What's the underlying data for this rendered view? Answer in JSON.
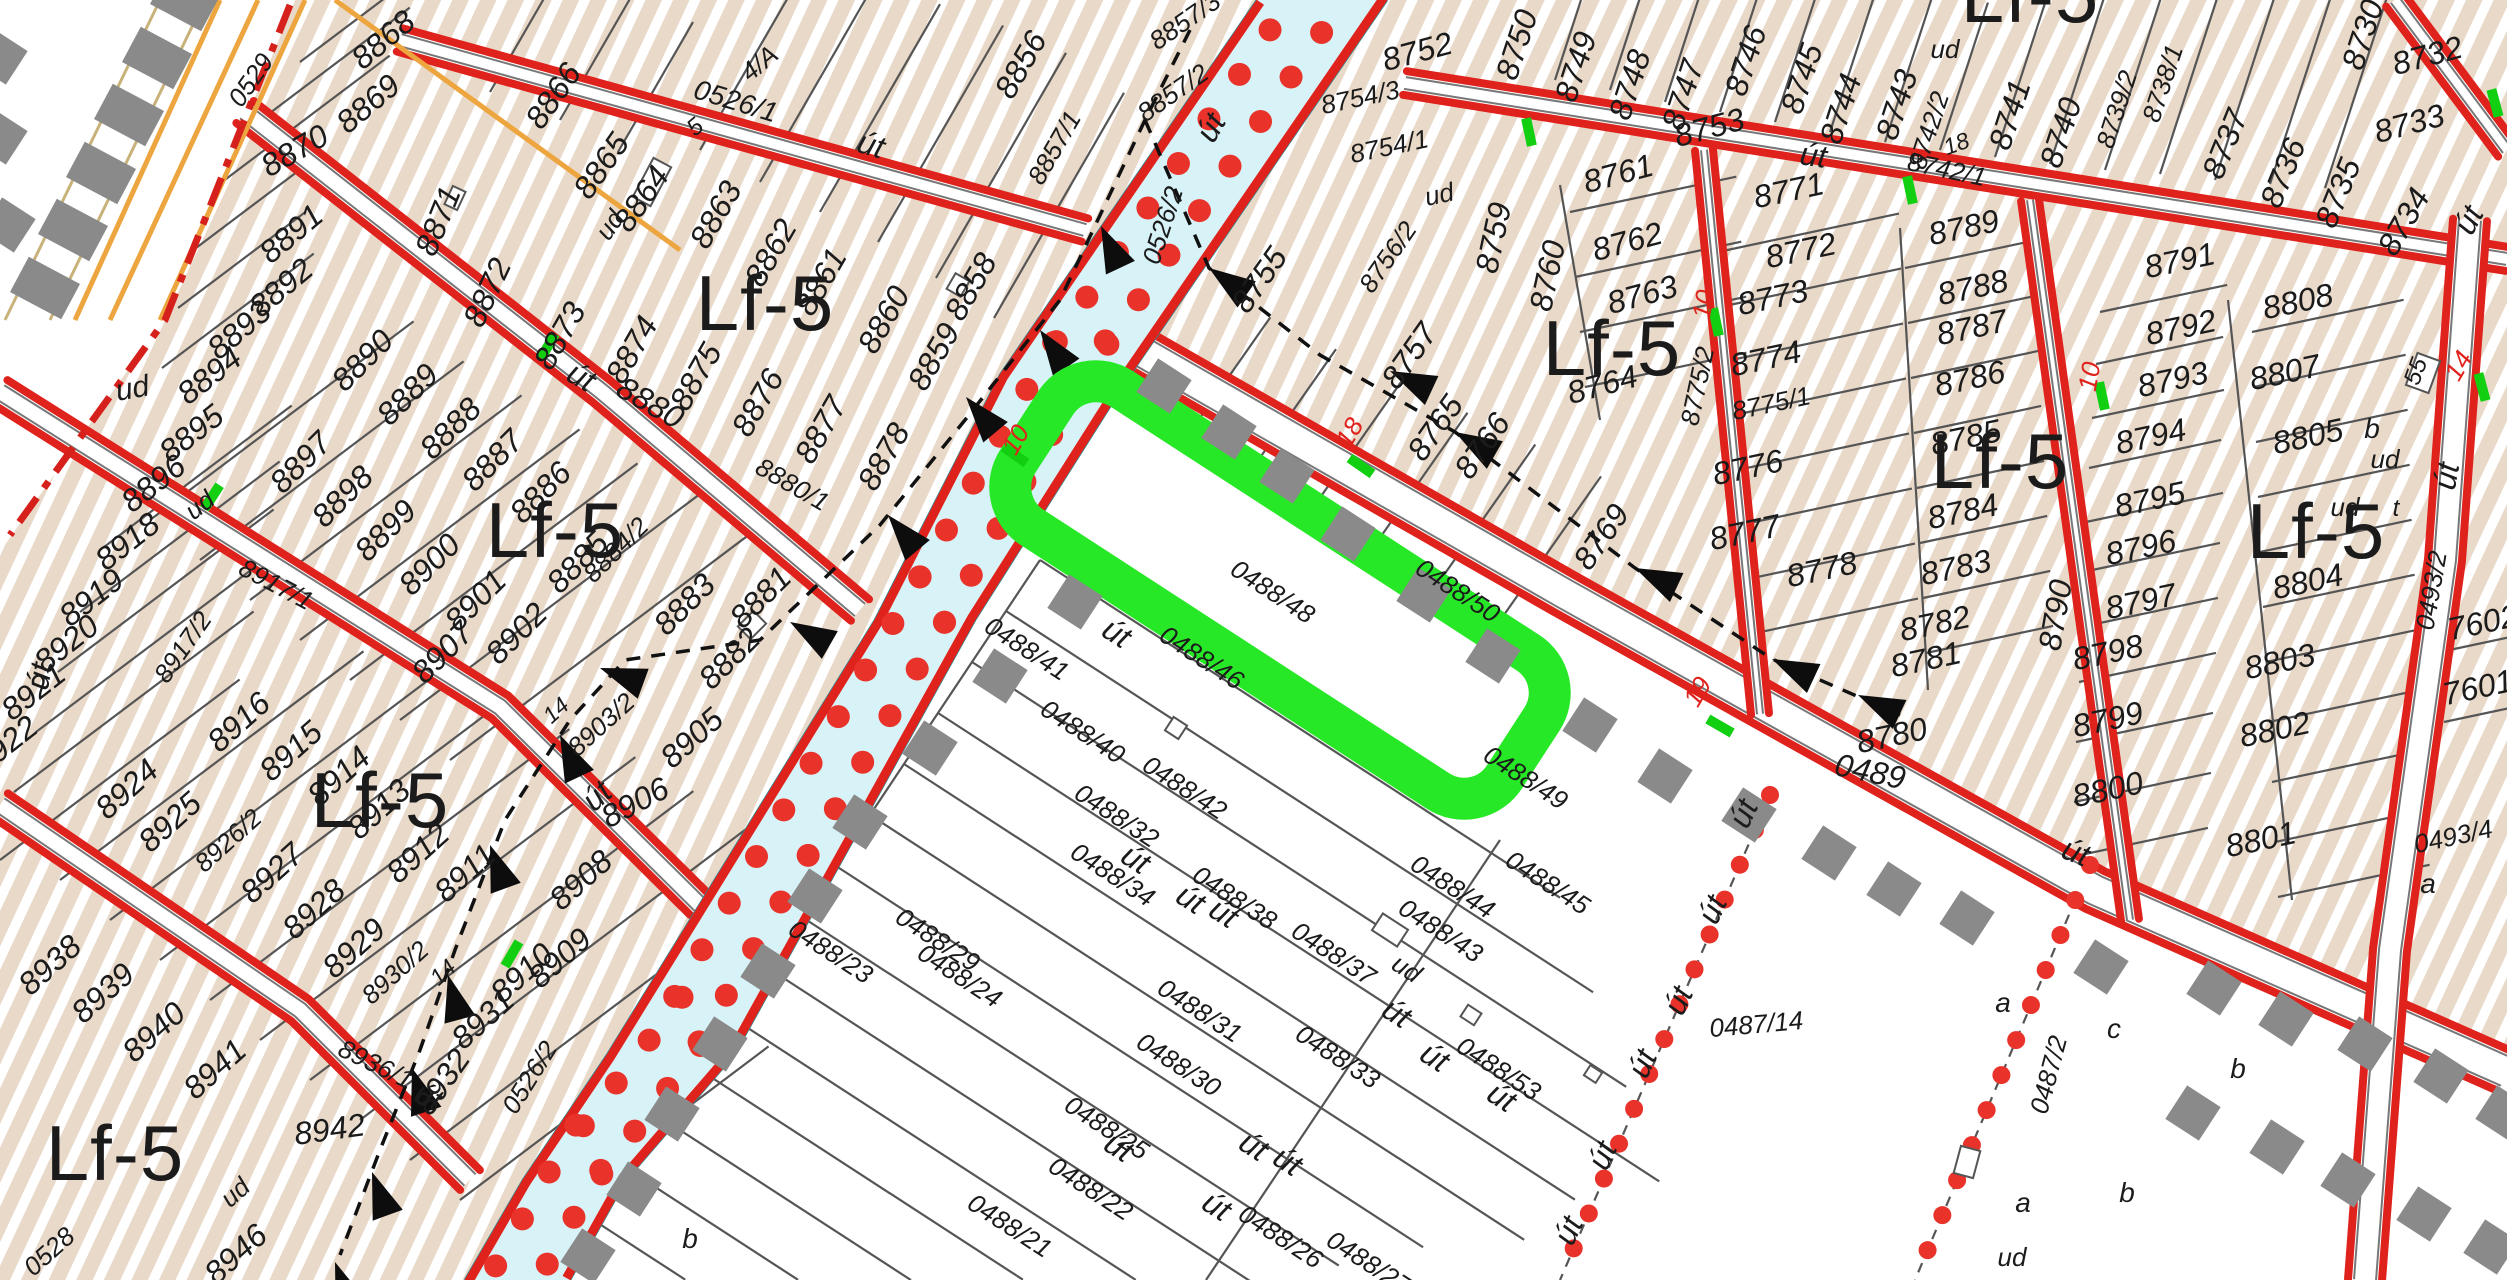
{
  "map": {
    "type": "cadastral-zoning-map",
    "highlighted_parcel": "0488/48",
    "zone_code": "Lf-5",
    "canal_parcel": "0526/2",
    "road_parcels": [
      "0526/1",
      "0489",
      "8880",
      "8917/1",
      "8936/1",
      "0493/2"
    ]
  },
  "colors": {
    "road_red": "#e0221c",
    "boundary_red": "#d6201b",
    "dot_red": "#e8322a",
    "hatch_bg": "#e9d9c9",
    "hatch_stripe": "#ffffff",
    "canal_fill": "#d8f3f8",
    "canal_edge": "#2b8c96",
    "highlight_green": "#27e827",
    "tick_green": "#12cf12",
    "railway_orange": "#eda63f",
    "square_gray": "#8a8a8a",
    "parcel_line": "#555555",
    "label_black": "#1b1b1b"
  },
  "zone_labels": [
    {
      "t": "Lf-5",
      "x": 765,
      "y": 330
    },
    {
      "t": "Lf-5",
      "x": 555,
      "y": 557
    },
    {
      "t": "Lf-5",
      "x": 380,
      "y": 827
    },
    {
      "t": "Lf-5",
      "x": 115,
      "y": 1180
    },
    {
      "t": "Lf-5",
      "x": 1612,
      "y": 375
    },
    {
      "t": "Lf-5",
      "x": 2000,
      "y": 488
    },
    {
      "t": "Lf-5",
      "x": 2316,
      "y": 558
    },
    {
      "t": "Lf-5",
      "x": 2030,
      "y": 22
    }
  ],
  "red_labels": [
    [
      "10",
      1023,
      444,
      -60
    ],
    [
      "18",
      1357,
      437,
      -60
    ],
    [
      "19",
      1705,
      696,
      -60
    ],
    [
      "10",
      1712,
      306,
      -80
    ],
    [
      "10",
      2098,
      378,
      -80
    ],
    [
      "14",
      2466,
      370,
      -60
    ]
  ],
  "labels": [
    [
      "0529",
      258,
      85,
      -55,
      26
    ],
    [
      "8868",
      390,
      48,
      -40
    ],
    [
      "8869",
      375,
      112,
      -40
    ],
    [
      "8870",
      300,
      160,
      -30
    ],
    [
      "8891",
      298,
      242,
      -40
    ],
    [
      "8892",
      288,
      296,
      -40
    ],
    [
      "8893",
      246,
      338,
      -40
    ],
    [
      "8894",
      216,
      384,
      -38
    ],
    [
      "8895",
      198,
      442,
      -38
    ],
    [
      "8896",
      160,
      492,
      -38
    ],
    [
      "ud",
      205,
      512,
      -38,
      26
    ],
    [
      "ud",
      134,
      398,
      -10,
      30
    ],
    [
      "8890",
      370,
      368,
      -45
    ],
    [
      "8889",
      415,
      402,
      -45
    ],
    [
      "8888",
      458,
      436,
      -45
    ],
    [
      "8897",
      308,
      470,
      -45
    ],
    [
      "8898",
      350,
      504,
      -45
    ],
    [
      "8899",
      393,
      538,
      -45
    ],
    [
      "8900",
      437,
      572,
      -45
    ],
    [
      "8901",
      483,
      608,
      -45
    ],
    [
      "8902",
      524,
      641,
      -45
    ],
    [
      "8918",
      134,
      550,
      -38
    ],
    [
      "8919",
      98,
      606,
      -38
    ],
    [
      "8920",
      73,
      652,
      -38
    ],
    [
      "8921",
      40,
      700,
      -38
    ],
    [
      "8922",
      12,
      753,
      -38
    ],
    [
      "8917/2",
      190,
      652,
      -55,
      26
    ],
    [
      "8917/1",
      272,
      592,
      28,
      26
    ],
    [
      "út",
      50,
      678,
      -80
    ],
    [
      "8907",
      450,
      660,
      -45
    ],
    [
      "8871",
      448,
      225,
      -68
    ],
    [
      "8872",
      497,
      297,
      -65
    ],
    [
      "8873",
      569,
      341,
      -60
    ],
    [
      "8874",
      641,
      355,
      -60
    ],
    [
      "8875",
      705,
      382,
      -60
    ],
    [
      "8876",
      767,
      408,
      -60
    ],
    [
      "8877",
      830,
      435,
      -60
    ],
    [
      "8878",
      893,
      462,
      -60
    ],
    [
      "8887",
      500,
      468,
      -45
    ],
    [
      "8886",
      548,
      500,
      -45
    ],
    [
      "8885",
      585,
      570,
      -45
    ],
    [
      "8884/2",
      622,
      556,
      -45,
      26
    ],
    [
      "8883",
      692,
      612,
      -45
    ],
    [
      "8881",
      768,
      605,
      -45
    ],
    [
      "8882",
      737,
      666,
      -45
    ],
    [
      "út",
      576,
      386,
      30
    ],
    [
      "8880",
      645,
      412,
      30
    ],
    [
      "8880/1",
      788,
      492,
      30,
      26
    ],
    [
      "8858",
      980,
      292,
      -60
    ],
    [
      "8859",
      943,
      362,
      -60
    ],
    [
      "8860",
      893,
      325,
      -60
    ],
    [
      "8861",
      830,
      287,
      -60
    ],
    [
      "8862",
      780,
      258,
      -60
    ],
    [
      "8863",
      725,
      220,
      -60
    ],
    [
      "8864",
      650,
      205,
      -55
    ],
    [
      "ud",
      617,
      230,
      -55,
      26
    ],
    [
      "8865",
      610,
      172,
      -55
    ],
    [
      "8866",
      562,
      102,
      -55
    ],
    [
      "5",
      700,
      133,
      -40,
      24
    ],
    [
      "4/A",
      765,
      70,
      -40,
      26
    ],
    [
      "0526/1",
      733,
      110,
      17,
      28
    ],
    [
      "út",
      868,
      155,
      17
    ],
    [
      "8856",
      1030,
      70,
      -60
    ],
    [
      "8857/3",
      1190,
      28,
      -35,
      26
    ],
    [
      "8857/2",
      1178,
      100,
      -35,
      26
    ],
    [
      "8857/1",
      1062,
      152,
      -60,
      26
    ],
    [
      "út",
      1220,
      133,
      -60
    ],
    [
      "0526/2",
      1171,
      228,
      -72,
      26
    ],
    [
      "0526/2",
      537,
      1082,
      -58,
      26
    ],
    [
      "8936/1",
      372,
      1072,
      26,
      26
    ],
    [
      "út",
      424,
      1106,
      26
    ],
    [
      "8924",
      134,
      797,
      -42
    ],
    [
      "8925",
      177,
      830,
      -42
    ],
    [
      "8926/2",
      234,
      847,
      -42,
      26
    ],
    [
      "8916",
      246,
      730,
      -42
    ],
    [
      "8915",
      298,
      759,
      -42
    ],
    [
      "8914",
      346,
      784,
      -42
    ],
    [
      "8913",
      386,
      817,
      -42
    ],
    [
      "8912",
      425,
      861,
      -42
    ],
    [
      "8911",
      472,
      881,
      -42
    ],
    [
      "8927",
      279,
      881,
      -42
    ],
    [
      "8928",
      321,
      917,
      -42
    ],
    [
      "8929",
      361,
      956,
      -42
    ],
    [
      "8930/2",
      401,
      979,
      -42,
      26
    ],
    [
      "14",
      448,
      978,
      -42,
      23
    ],
    [
      "8938",
      57,
      973,
      -42
    ],
    [
      "8939",
      110,
      1001,
      -42
    ],
    [
      "8940",
      161,
      1040,
      -42
    ],
    [
      "8941",
      222,
      1077,
      -42
    ],
    [
      "8942",
      331,
      1140,
      -8
    ],
    [
      "8946",
      243,
      1262,
      -42
    ],
    [
      "8931",
      490,
      1027,
      -42
    ],
    [
      "8932",
      451,
      1088,
      -55
    ],
    [
      "8910",
      529,
      981,
      -42
    ],
    [
      "8909",
      567,
      966,
      -42
    ],
    [
      "8908",
      588,
      888,
      -42
    ],
    [
      "8906",
      640,
      812,
      -28
    ],
    [
      "út",
      604,
      804,
      -42
    ],
    [
      "8905",
      699,
      746,
      -42
    ],
    [
      "8903/2",
      607,
      731,
      -42,
      26
    ],
    [
      "14",
      561,
      716,
      -42,
      23
    ],
    [
      "0528",
      55,
      1258,
      -42,
      26
    ],
    [
      "ud",
      241,
      1199,
      -42,
      26
    ],
    [
      "b",
      690,
      1248,
      0,
      28
    ],
    [
      "8752",
      1420,
      62,
      -15
    ],
    [
      "8754/3",
      1362,
      106,
      -12,
      26
    ],
    [
      "8754/1",
      1391,
      155,
      -12,
      26
    ],
    [
      "ud",
      1441,
      203,
      -12,
      26
    ],
    [
      "8756/2",
      1395,
      262,
      -55,
      26
    ],
    [
      "8755",
      1268,
      286,
      -55
    ],
    [
      "8757",
      1418,
      362,
      -55
    ],
    [
      "8759",
      1504,
      240,
      -78
    ],
    [
      "8760",
      1558,
      278,
      -78
    ],
    [
      "8761",
      1621,
      184,
      -15
    ],
    [
      "8762",
      1630,
      252,
      -15
    ],
    [
      "8763",
      1645,
      305,
      -15
    ],
    [
      "8764",
      1605,
      395,
      -15
    ],
    [
      "8750",
      1527,
      48,
      -72
    ],
    [
      "8749",
      1586,
      70,
      -72
    ],
    [
      "8748",
      1640,
      88,
      -72
    ],
    [
      "8747",
      1693,
      98,
      -72
    ],
    [
      "8746",
      1756,
      64,
      -72
    ],
    [
      "8745",
      1812,
      82,
      -72
    ],
    [
      "8744",
      1851,
      112,
      -72
    ],
    [
      "8743",
      1907,
      108,
      -72
    ],
    [
      "8742/2",
      1937,
      133,
      -72,
      26
    ],
    [
      "ud",
      1945,
      58,
      0,
      26
    ],
    [
      "18",
      1959,
      151,
      -20,
      23
    ],
    [
      "8742/1",
      1945,
      178,
      12,
      26
    ],
    [
      "8741",
      2020,
      118,
      -72
    ],
    [
      "8740",
      2071,
      136,
      -72
    ],
    [
      "8739/2",
      2125,
      112,
      -72,
      26
    ],
    [
      "8738/1",
      2171,
      86,
      -72,
      26
    ],
    [
      "8737",
      2235,
      148,
      -68
    ],
    [
      "8736",
      2293,
      177,
      -68
    ],
    [
      "8735",
      2348,
      197,
      -68
    ],
    [
      "8734",
      2413,
      227,
      -60
    ],
    [
      "8733",
      2412,
      134,
      -15
    ],
    [
      "8732",
      2430,
      66,
      -15
    ],
    [
      "8730",
      2373,
      38,
      -72
    ],
    [
      "8753",
      1712,
      138,
      -15
    ],
    [
      "út",
      1812,
      166,
      8
    ],
    [
      "8765",
      1444,
      434,
      -55
    ],
    [
      "8766",
      1491,
      452,
      -55
    ],
    [
      "8769",
      1610,
      543,
      -55
    ],
    [
      "8771",
      1791,
      201,
      -12
    ],
    [
      "8772",
      1803,
      261,
      -12
    ],
    [
      "8773",
      1775,
      308,
      -12
    ],
    [
      "8774",
      1768,
      369,
      -12
    ],
    [
      "8775/1",
      1773,
      412,
      -12,
      26
    ],
    [
      "8775/2",
      1706,
      388,
      -78,
      26
    ],
    [
      "8776",
      1750,
      478,
      -12
    ],
    [
      "8777",
      1747,
      543,
      -12
    ],
    [
      "8778",
      1824,
      580,
      -12
    ],
    [
      "8789",
      1966,
      238,
      -12
    ],
    [
      "8788",
      1975,
      298,
      -12
    ],
    [
      "8787",
      1974,
      338,
      -12
    ],
    [
      "8786",
      1972,
      389,
      -12
    ],
    [
      "8785",
      1968,
      448,
      -12
    ],
    [
      "8784",
      1965,
      522,
      -12
    ],
    [
      "8783",
      1958,
      578,
      -12
    ],
    [
      "8782",
      1937,
      634,
      -12
    ],
    [
      "8781",
      1928,
      670,
      -12
    ],
    [
      "8780",
      1894,
      746,
      -12
    ],
    [
      "8790",
      2066,
      617,
      -80
    ],
    [
      "8791",
      2182,
      271,
      -12
    ],
    [
      "8792",
      2183,
      338,
      -12
    ],
    [
      "8793",
      2175,
      390,
      -12
    ],
    [
      "8794",
      2153,
      447,
      -12
    ],
    [
      "8795",
      2152,
      510,
      -12
    ],
    [
      "8796",
      2143,
      558,
      -12
    ],
    [
      "8797",
      2143,
      612,
      -12
    ],
    [
      "8798",
      2110,
      663,
      -12
    ],
    [
      "8799",
      2110,
      730,
      -12
    ],
    [
      "8800",
      2110,
      800,
      -12
    ],
    [
      "8801",
      2263,
      850,
      -12
    ],
    [
      "8802",
      2277,
      740,
      -12
    ],
    [
      "8803",
      2282,
      672,
      -12
    ],
    [
      "8804",
      2310,
      592,
      -12
    ],
    [
      "8805",
      2310,
      447,
      -12
    ],
    [
      "b",
      2372,
      438,
      0,
      28
    ],
    [
      "ud",
      2385,
      468,
      0,
      26
    ],
    [
      "ud",
      2345,
      516,
      0,
      26
    ],
    [
      "t",
      2396,
      516,
      0,
      24
    ],
    [
      "8807",
      2287,
      383,
      -12
    ],
    [
      "55",
      2423,
      374,
      -70,
      24
    ],
    [
      "8808",
      2300,
      312,
      -12
    ],
    [
      "0493/2",
      2440,
      592,
      -80,
      26
    ],
    [
      "út",
      2457,
      478,
      -80
    ],
    [
      "út",
      2478,
      225,
      -62
    ],
    [
      "7602",
      2485,
      633,
      -12
    ],
    [
      "7601",
      2480,
      698,
      -12
    ],
    [
      "0493/4",
      2455,
      845,
      -12,
      26
    ],
    [
      "a",
      2428,
      893,
      0,
      28
    ],
    [
      "0489",
      1868,
      782,
      12
    ],
    [
      "út",
      2072,
      862,
      22
    ],
    [
      "0487/14",
      1757,
      1033,
      -5,
      26
    ],
    [
      "a",
      2003,
      1012,
      0,
      28
    ],
    [
      "c",
      2114,
      1038,
      0,
      28
    ],
    [
      "b",
      2238,
      1078,
      0,
      28
    ],
    [
      "0487/2",
      2057,
      1077,
      -75,
      26
    ],
    [
      "a",
      2023,
      1212,
      0,
      28
    ],
    [
      "b",
      2127,
      1202,
      0,
      28
    ],
    [
      "ud",
      2012,
      1266,
      0,
      26
    ],
    [
      "út",
      1753,
      818,
      -65
    ],
    [
      "út",
      1722,
      914,
      -65
    ],
    [
      "út",
      1688,
      1005,
      -65
    ],
    [
      "út",
      1652,
      1068,
      -65
    ],
    [
      "út",
      1612,
      1160,
      -65
    ],
    [
      "út",
      1578,
      1235,
      -65
    ],
    [
      "0488/41",
      1022,
      656,
      33,
      26
    ],
    [
      "út",
      1111,
      642,
      33
    ],
    [
      "0488/40",
      1078,
      739,
      33,
      26
    ],
    [
      "0488/32",
      1112,
      823,
      33,
      26
    ],
    [
      "0488/34",
      1108,
      882,
      33,
      26
    ],
    [
      "út",
      1130,
      868,
      33
    ],
    [
      "0488/23",
      826,
      959,
      33,
      26
    ],
    [
      "0488/29",
      933,
      947,
      33,
      26
    ],
    [
      "0488/24",
      955,
      983,
      33,
      26
    ],
    [
      "0488/22",
      1086,
      1196,
      33,
      26
    ],
    [
      "0488/21",
      1005,
      1233,
      33,
      26
    ],
    [
      "0488/25",
      1102,
      1135,
      33,
      26
    ],
    [
      "út",
      1113,
      1156,
      33
    ],
    [
      "0488/30",
      1174,
      1072,
      33,
      26
    ],
    [
      "0488/31",
      1195,
      1018,
      33,
      26
    ],
    [
      "0488/33",
      1333,
      1064,
      33,
      26
    ],
    [
      "0488/37",
      1329,
      961,
      33,
      26
    ],
    [
      "ud",
      1402,
      976,
      33,
      26
    ],
    [
      "út",
      1391,
      1022,
      33
    ],
    [
      "út",
      1429,
      1066,
      33
    ],
    [
      "0488/26",
      1276,
      1244,
      33,
      26
    ],
    [
      "0488/27",
      1364,
      1270,
      33,
      26
    ],
    [
      "út",
      1211,
      1215,
      33
    ],
    [
      "út",
      1248,
      1155,
      33
    ],
    [
      "út",
      1282,
      1170,
      33
    ],
    [
      "0488/38",
      1230,
      905,
      33,
      26
    ],
    [
      "út",
      1185,
      908,
      33
    ],
    [
      "út",
      1218,
      922,
      33
    ],
    [
      "0488/42",
      1180,
      795,
      33,
      26
    ],
    [
      "0488/46",
      1197,
      665,
      33,
      26
    ],
    [
      "0488/48",
      1268,
      599,
      33,
      26
    ],
    [
      "0488/50",
      1453,
      598,
      33,
      26
    ],
    [
      "0488/49",
      1521,
      785,
      33,
      26
    ],
    [
      "0488/44",
      1448,
      894,
      33,
      26
    ],
    [
      "0488/43",
      1436,
      938,
      33,
      26
    ],
    [
      "0488/45",
      1543,
      890,
      33,
      26
    ],
    [
      "0488/53",
      1494,
      1076,
      33,
      26
    ],
    [
      "út",
      1496,
      1106,
      33
    ]
  ]
}
